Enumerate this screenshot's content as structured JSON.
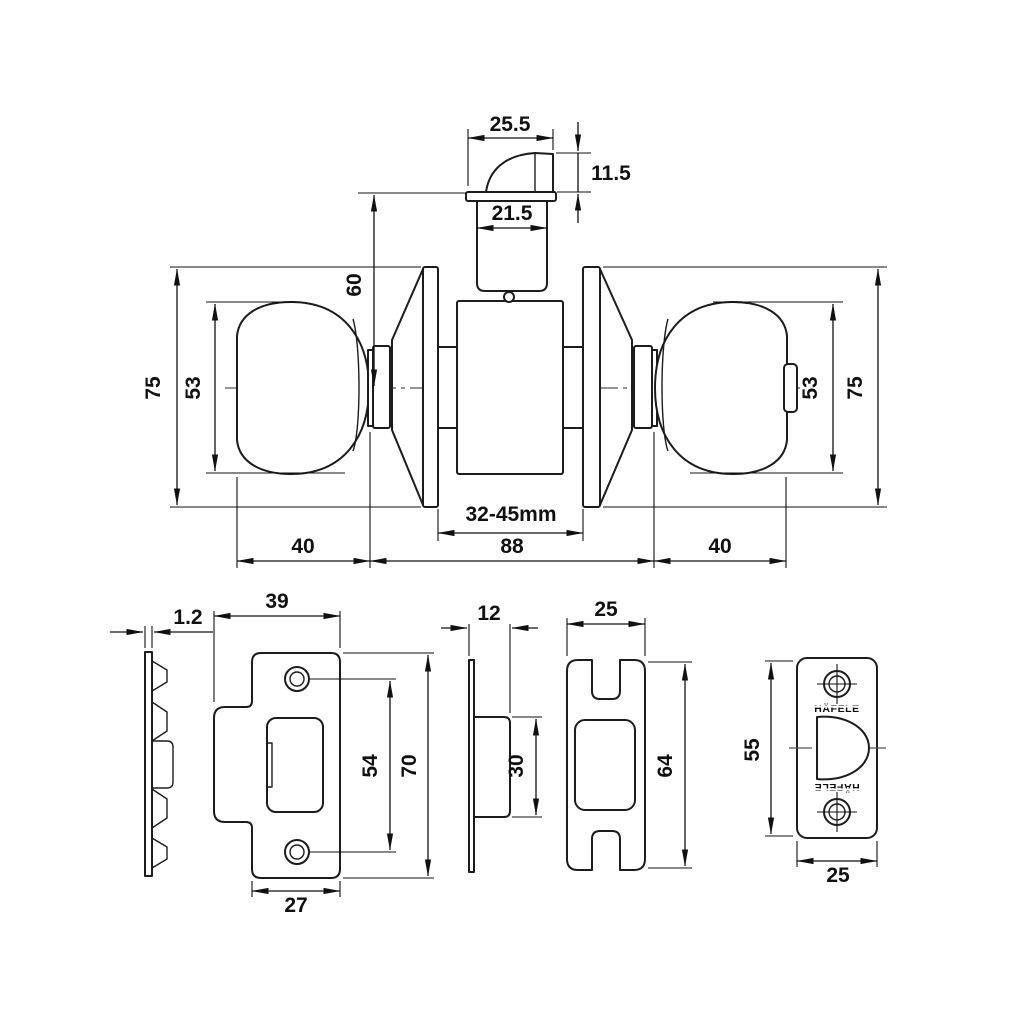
{
  "dims": {
    "turn_width": "25.5",
    "turn_height": "11.5",
    "cyl_width": "21.5",
    "cyl_to_center": "60",
    "rose_dia_left": "75",
    "knob_dia_left": "53",
    "knob_dia_right": "53",
    "rose_dia_right": "75",
    "proj_left": "40",
    "body": "88",
    "proj_right": "40",
    "door_range": "32-45mm",
    "plate_thick": "1.2",
    "strike_width": "39",
    "hole_span": "54",
    "strike_height": "70",
    "strike_lower_width": "27",
    "latch_depth": "12",
    "case_height": "30",
    "latch_width": "25",
    "latch_height": "64",
    "face_height": "55",
    "face_width": "25"
  },
  "brand": {
    "top": "HÄFELE",
    "bottom": "HÄFELE"
  },
  "colors": {
    "line": "#1c1c1c",
    "dim": "#111111",
    "centerline": "#555555",
    "background": "#ffffff"
  }
}
